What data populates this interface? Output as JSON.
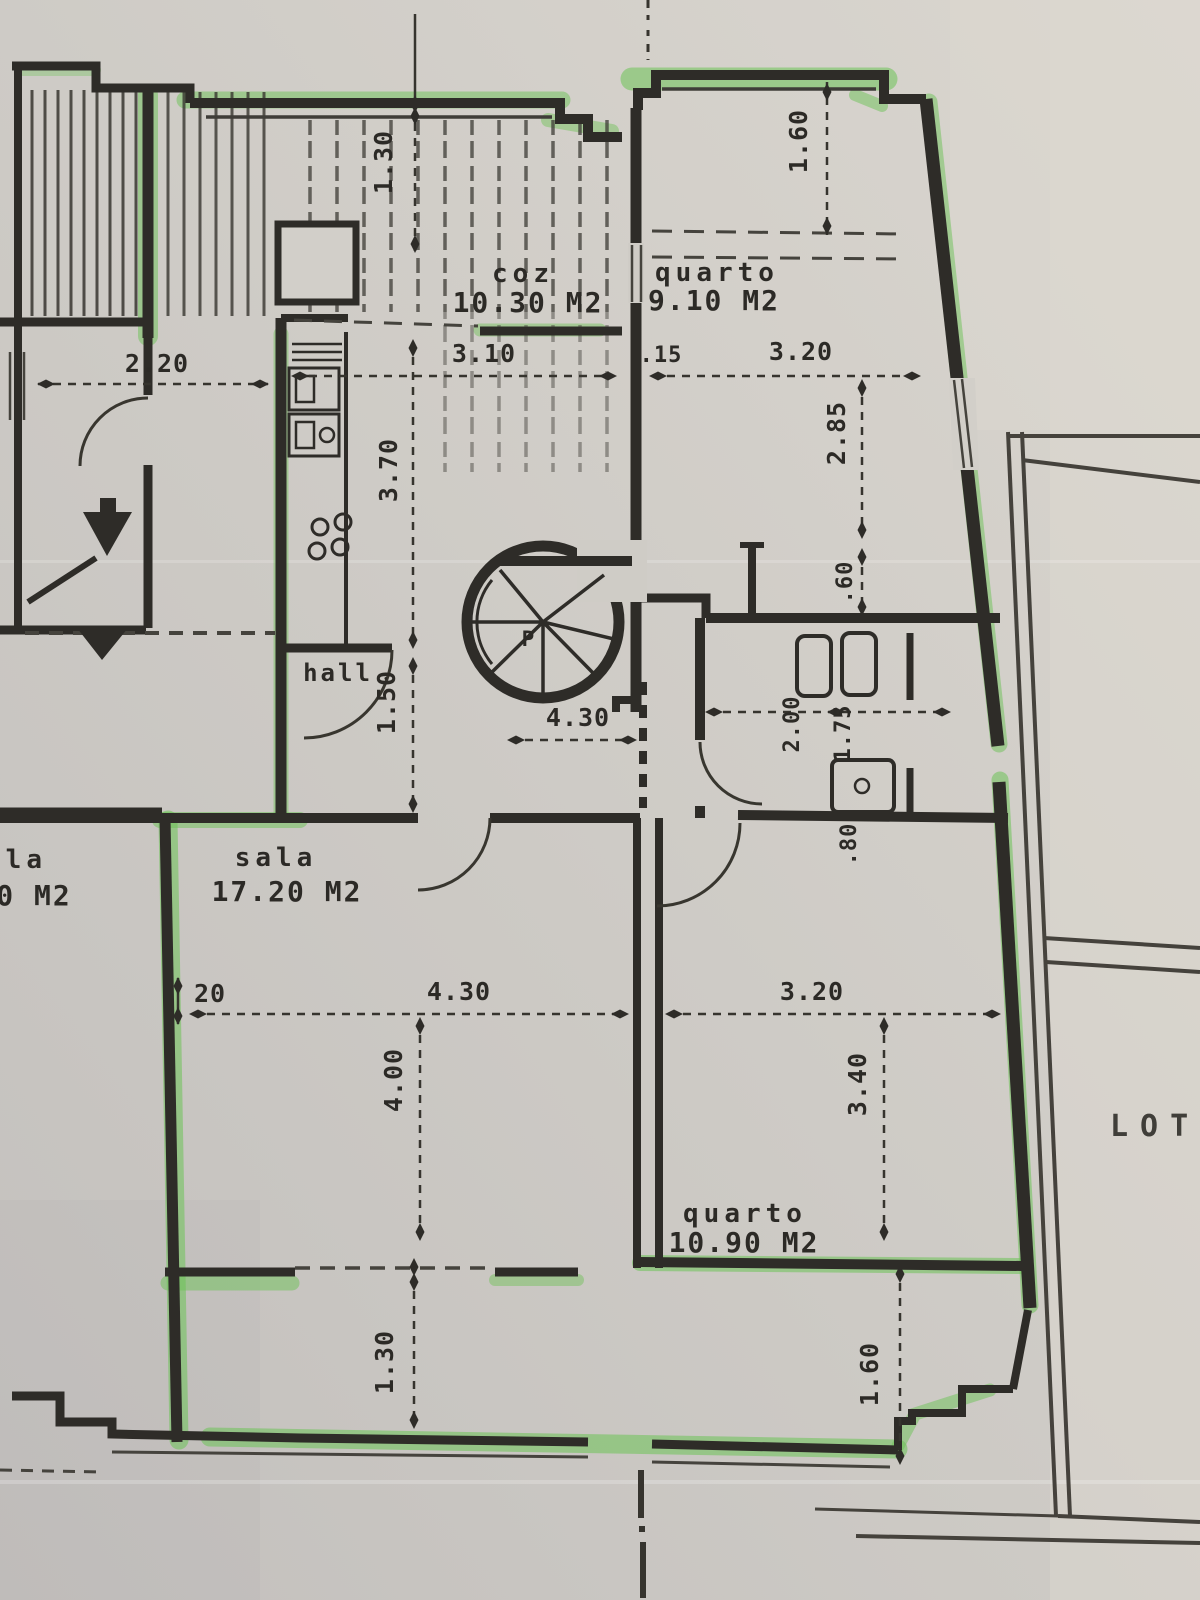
{
  "document": {
    "type": "floor-plan-photo",
    "lote_label": "LOTE"
  },
  "rooms": {
    "cozinha": {
      "label": "coz",
      "area": "10.30 M2"
    },
    "quarto_top": {
      "label": "quarto",
      "area": "9.10 M2"
    },
    "sala": {
      "label": "sala",
      "area": "17.20 M2"
    },
    "quarto_bottom": {
      "label": "quarto",
      "area": "10.90 M2"
    },
    "hall": {
      "label": "hall"
    },
    "neighbor_sala": {
      "label": "ala",
      "area": "0 M2"
    }
  },
  "stair": {
    "platform_label": "P"
  },
  "dimensions": {
    "terrace_top": "1.30",
    "terrace_top_right": "1.60",
    "left_room_width": "2.20",
    "cozinha_width": "3.10",
    "wall_thickness": ".15",
    "quarto_top_width": "3.20",
    "quarto_top_depth": "2.85",
    "nook_depth": ".60",
    "cozinha_depth": "3.70",
    "hall_depth": "1.50",
    "hall_width": "4.30",
    "bath_span_a": "2.00",
    "bath_span_b": "1.75",
    "closet_depth": ".80",
    "wall_tick": "20",
    "sala_width": "4.30",
    "sala_depth": "4.00",
    "quarto_bottom_width": "3.20",
    "quarto_bottom_depth": "3.40",
    "balcony_depth_left": "1.30",
    "balcony_depth_right": "1.60"
  },
  "colors": {
    "paper": "#cfccc6",
    "ink": "#32302b",
    "highlighter": "#6cc255"
  }
}
